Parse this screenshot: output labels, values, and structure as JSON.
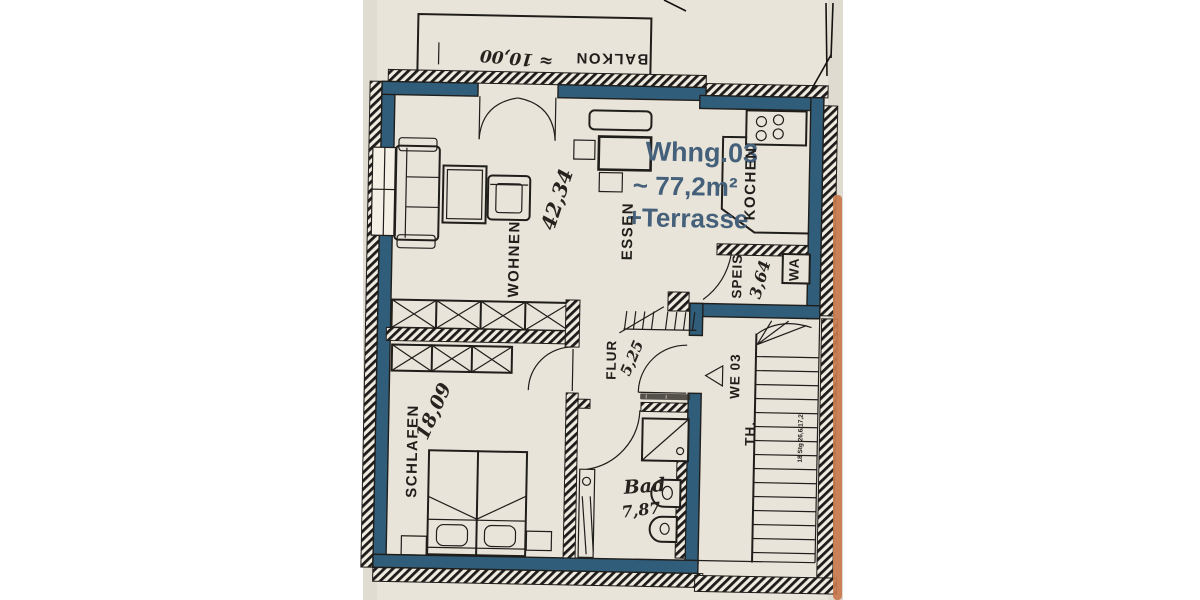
{
  "unit_info": {
    "name": "Whng.03",
    "area": "~ 77,2m²",
    "terrace": "+Terrasse"
  },
  "balcony": {
    "label": "BALKON",
    "area": "≈ 10,00"
  },
  "rooms": [
    {
      "id": "wohnen",
      "label": "WOHNEN",
      "area": "42,34"
    },
    {
      "id": "essen",
      "label": "ESSEN",
      "area": ""
    },
    {
      "id": "kochen",
      "label": "KOCHEN",
      "area": ""
    },
    {
      "id": "speis",
      "label": "SPEIS",
      "area": "3,64"
    },
    {
      "id": "flur",
      "label": "FLUR",
      "area": "5,25"
    },
    {
      "id": "schlafen",
      "label": "SCHLAFEN",
      "area": "18,09"
    },
    {
      "id": "bad",
      "label": "Bad",
      "area": "7,87"
    }
  ],
  "stairwell": {
    "unit_door_label": "WE 03",
    "stair_hall_label": "TH.",
    "stair_note": "18 Stg 26,6/17,2"
  },
  "appliances": {
    "washing_machine": "WA"
  },
  "colors": {
    "wall_blue": "#2f5d7a",
    "accent_text": "#44607a",
    "marker_orange": "#c8794d",
    "paper": "#e9e4d9",
    "ink": "#201e1b"
  }
}
